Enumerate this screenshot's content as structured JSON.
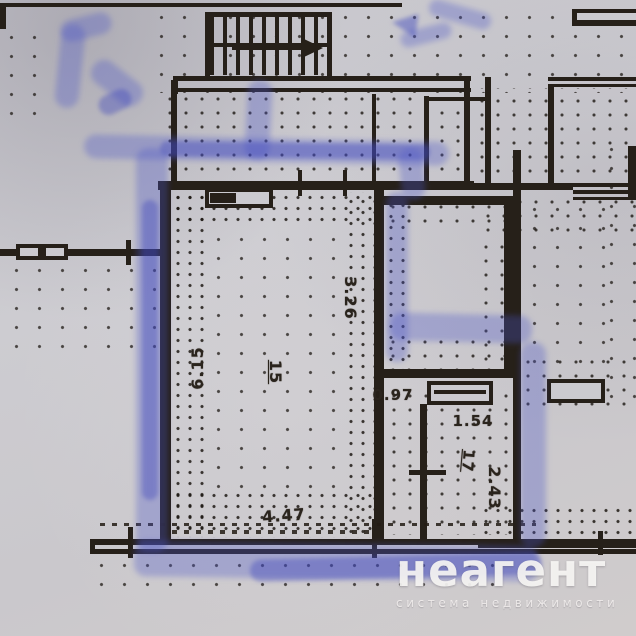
{
  "plan": {
    "dimensions": {
      "left_height": "6.15",
      "bottom_width": "4.47",
      "alcove_height": "3.26",
      "passage_width": "0.97",
      "small_room_width": "1.54",
      "small_room_height": "2.43"
    },
    "rooms": {
      "main_room_number": "15",
      "small_room_number": "17"
    }
  },
  "watermark": {
    "brand": "неагент",
    "tagline": "система недвижимости"
  },
  "colors": {
    "ink": "#262019",
    "marker_blue": "#4c54c6",
    "paper": "#cac9ce",
    "watermark_text": "#f8f6f4"
  }
}
